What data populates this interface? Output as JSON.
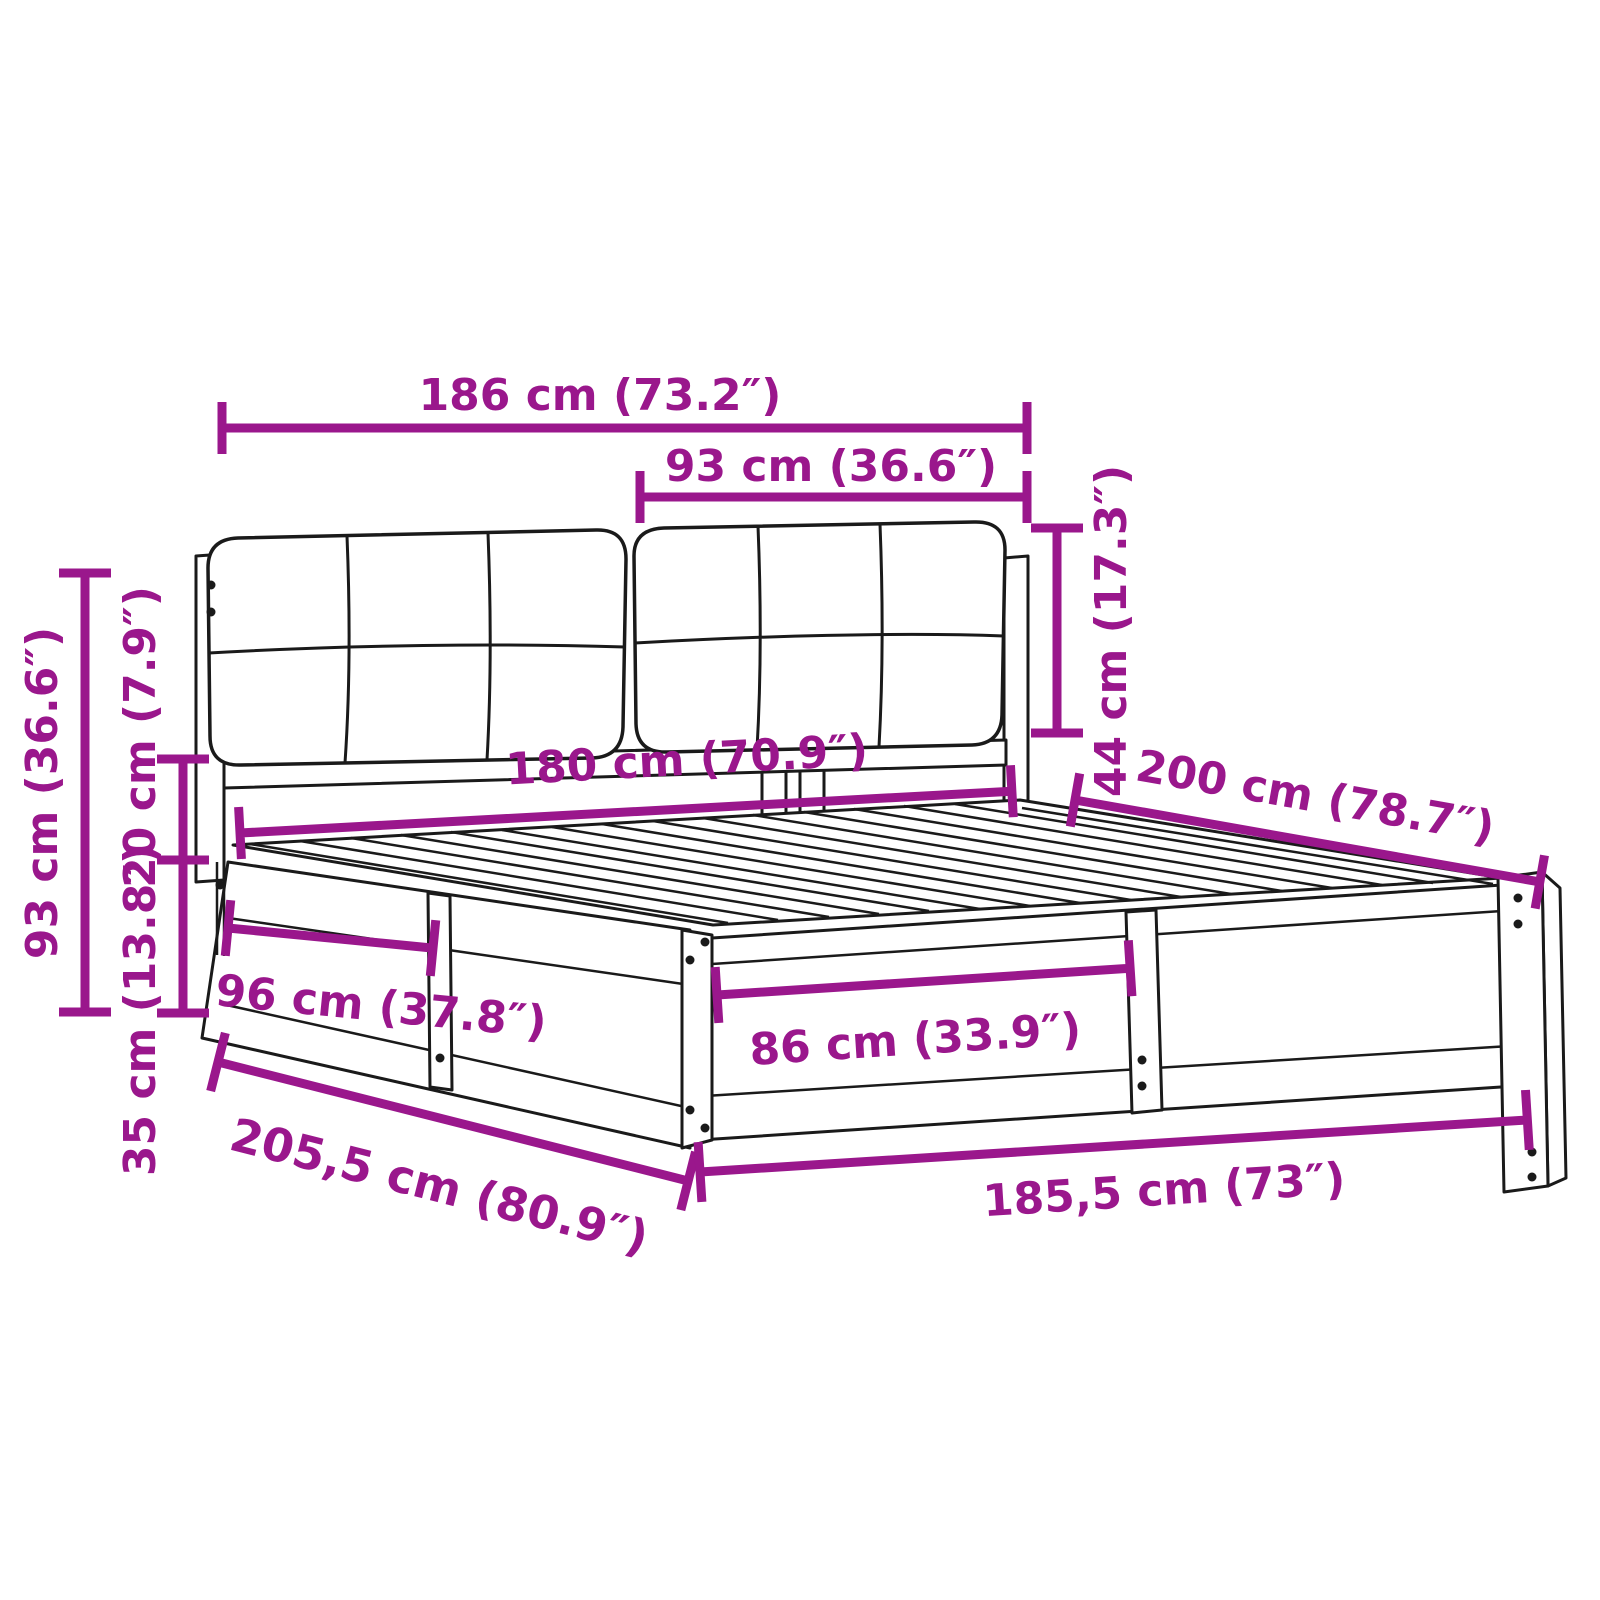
{
  "illustration": {
    "title": "Bed frame with upholstered headboard — dimension diagram",
    "colors": {
      "accent": "#9A178C",
      "line": "#1a1a1a",
      "background": "#ffffff"
    }
  },
  "dimensions": {
    "headboard_total_width": {
      "text": "186 cm (73.2″)"
    },
    "cushion_width": {
      "text": "93 cm (36.6″)"
    },
    "cushion_height": {
      "text": "44 cm (17.3″)"
    },
    "inner_width": {
      "text": "180 cm (70.9″)"
    },
    "bed_length": {
      "text": "200 cm (78.7″)"
    },
    "headboard_height": {
      "text": "93 cm (36.6″)"
    },
    "clearance_height": {
      "text": "20 cm (7.9″)"
    },
    "base_height": {
      "text": "35 cm (13.8″)"
    },
    "side_section_length": {
      "text": "96 cm (37.8″)"
    },
    "front_section_length": {
      "text": "86 cm (33.9″)"
    },
    "total_length": {
      "text": "205,5 cm (80.9″)"
    },
    "total_width": {
      "text": "185,5 cm (73″)"
    }
  }
}
